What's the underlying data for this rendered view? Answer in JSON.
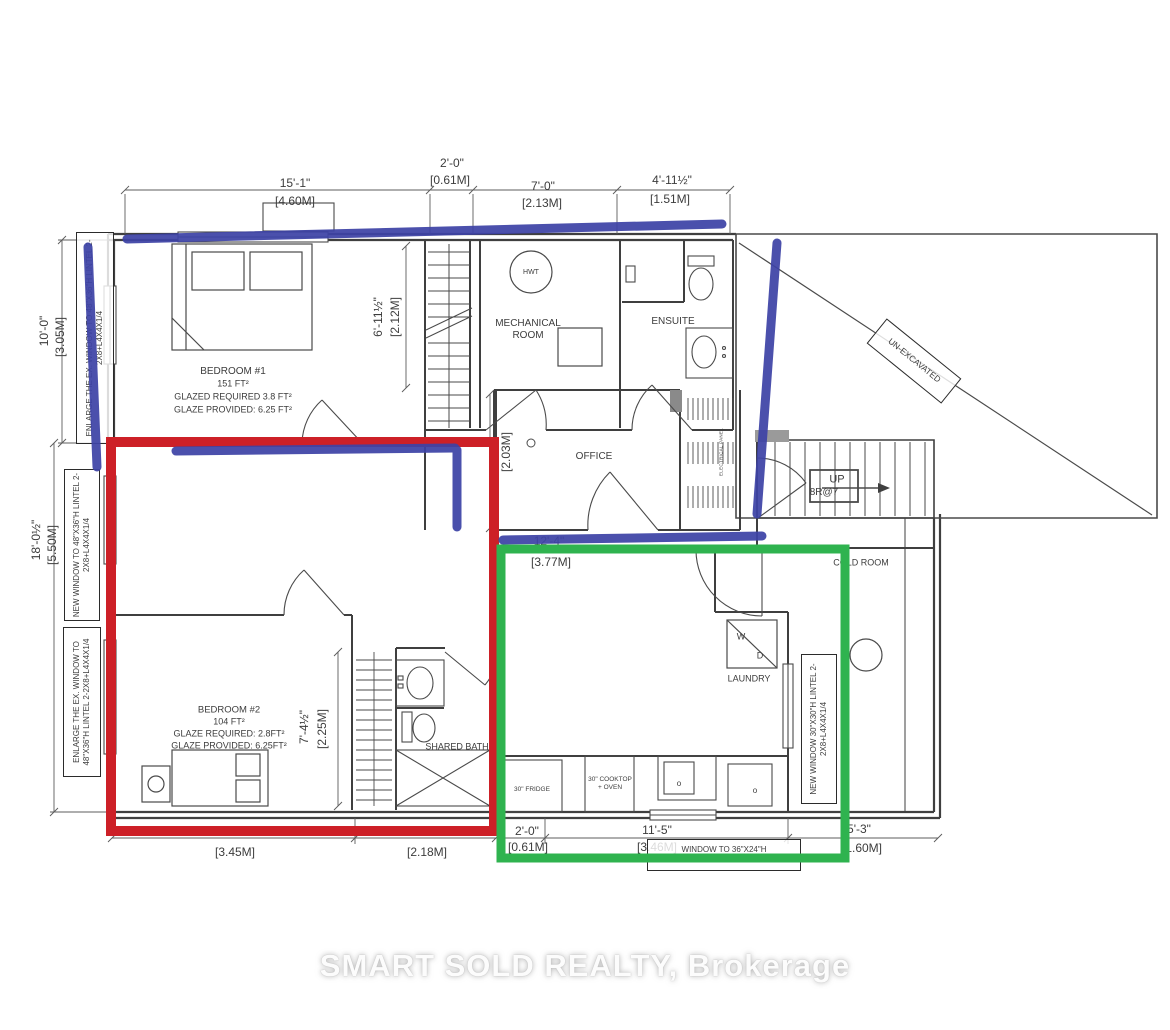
{
  "watermark": "SMART SOLD REALTY, Brokerage",
  "colors": {
    "red_annotation": "#cd2027",
    "green_annotation": "#2fb34f",
    "blue_marker": "#3d43a6"
  },
  "dims": {
    "d15_ft": "15'-1\"",
    "d15_m": "[4.60M]",
    "d2_ft": "2'-0\"",
    "d2_m": "[0.61M]",
    "d7_ft": "7'-0\"",
    "d7_m": "[2.13M]",
    "d411_ft": "4'-11½\"",
    "d411_m": "[1.51M]",
    "d10_ft": "10'-0\"",
    "d10_m": "[3.05M]",
    "d18_ft": "18'-0½\"",
    "d18_m": "[5.50M]",
    "d611_ft": "6'-11½\"",
    "d611_m": "[2.12M]",
    "d203_m": "[2.03M]",
    "d74_ft": "7'-4½\"",
    "d74_m": "[2.25M]",
    "d124_ft": "12'-4\"",
    "d124_m": "[3.77M]",
    "d345_m": "[3.45M]",
    "d218_m": "[2.18M]",
    "d20b_ft": "2'-0\"",
    "d20b_m": "[0.61M]",
    "d115_ft": "11'-5\"",
    "d115_m": "[3.46M]",
    "d53_ft": "5'-3\"",
    "d53_m": "[1.60M]"
  },
  "rooms": {
    "bedroom1": {
      "name": "BEDROOM #1",
      "area": "151 FT²",
      "req": "GLAZED REQUIRED 3.8 FT²",
      "prov": "GLAZE PROVIDED: 6.25 FT²"
    },
    "bedroom2": {
      "name": "BEDROOM #2",
      "area": "104 FT²",
      "req": "GLAZE REQUIRED: 2.8FT²",
      "prov": "GLAZE PROVIDED: 6.25FT²"
    },
    "mechanical": "MECHANICAL ROOM",
    "ensuite": "ENSUITE",
    "office": "OFFICE",
    "shared_bath": "SHARED BATH",
    "laundry": "LAUNDRY",
    "cold_room": "COLD ROOM",
    "unexcavated": "UN-EXCAVATED",
    "hwt": "HWT",
    "wd_w": "W",
    "wd_d": "D",
    "up": "UP",
    "risers": "8R@7",
    "electrical": "ELECTRICAL PANEL",
    "fridge": "30\" FRIDGE",
    "cooktop": "30\" COOKTOP + OVEN",
    "knob": "o"
  },
  "notes": {
    "left_top": "ENLARGE THE EX. WINDOW TO 48\"X36\"H LINTEL 2-2X8+L4X4X1/4",
    "left_mid": "NEW WINDOW TO 48\"X36\"H LINTEL 2-2X8+L4X4X1/4",
    "left_bottom": "ENLARGE THE EX. WINDOW TO 48\"X36\"H LINTEL 2-2X8+L4X4X1/4",
    "right": "NEW WINDOW 30\"X30\"H LINTEL 2-2X8+L4X4X1/4",
    "bottom1": "WINDOW TO 36\"X24\"H",
    "bottom2": "LINTEL 2-2X8+L4X4X1/4"
  }
}
